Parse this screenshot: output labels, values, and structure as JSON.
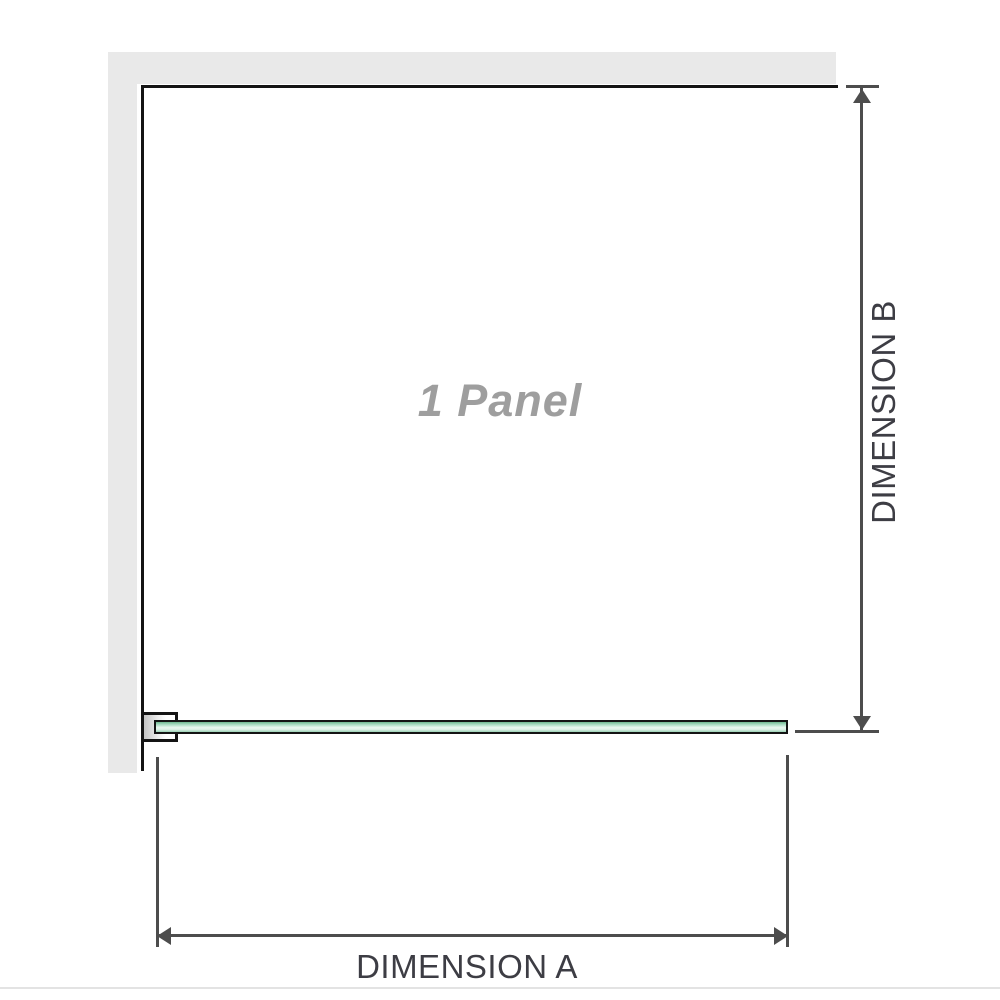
{
  "diagram": {
    "panel_label": "1 Panel",
    "dimension_a_label": "DIMENSION A",
    "dimension_b_label": "DIMENSION B"
  },
  "colors": {
    "wall_fill": "#e9e9e9",
    "edge_black": "#141414",
    "dimension_line": "#4d4d4d",
    "dimension_text": "#3d3d44",
    "panel_label_text": "#9e9e9e",
    "glass_green_dark": "#6fb890",
    "glass_green_mid": "#a9dcc2",
    "glass_green_light": "#e9f8f0",
    "bracket_inner_gray": "#c4c4c4",
    "bottom_divider": "#e3e3e3"
  }
}
